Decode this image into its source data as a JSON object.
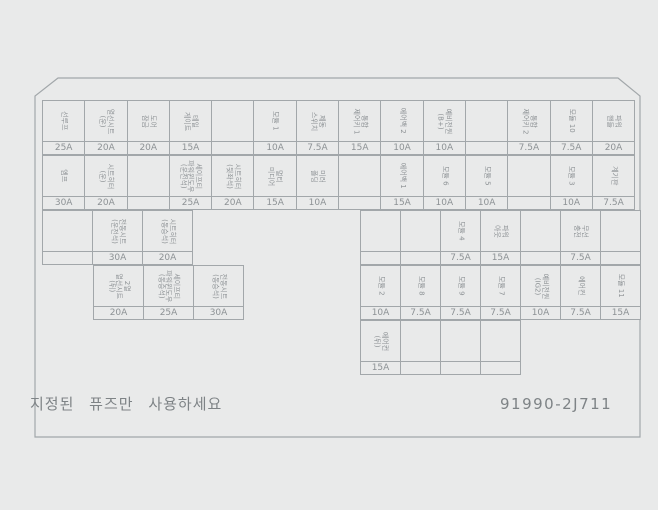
{
  "panel": {
    "warning_text": "지정된 퓨즈만 사용하세요",
    "part_number": "91990-2J711",
    "colors": {
      "line": "#a2a7aa",
      "text": "#8d9295",
      "background": "#e9eaea"
    },
    "rows": [
      {
        "id": "main-row-1",
        "cells": [
          {
            "label": "선루프",
            "amp": "25A"
          },
          {
            "label": "열선시트\n(운)",
            "amp": "20A"
          },
          {
            "label": "도어\n잠금",
            "amp": "20A"
          },
          {
            "label": "테일\n게이트",
            "amp": "15A"
          },
          {
            "label": "",
            "amp": ""
          },
          {
            "label": "모듈 1",
            "amp": "10A"
          },
          {
            "label": "제동\n스위치",
            "amp": "7.5A"
          },
          {
            "label": "통합\n제어키 1",
            "amp": "15A"
          },
          {
            "label": "에어백 2",
            "amp": "10A"
          },
          {
            "label": "예비전원\n(B+)",
            "amp": "10A"
          },
          {
            "label": "",
            "amp": ""
          },
          {
            "label": "통합\n제어키 2",
            "amp": "7.5A"
          },
          {
            "label": "모듈 10",
            "amp": "7.5A"
          },
          {
            "label": "파워\n핸들",
            "amp": "20A"
          }
        ]
      },
      {
        "id": "main-row-2",
        "cells": [
          {
            "label": "엠프",
            "amp": "30A"
          },
          {
            "label": "시트히터\n(운)",
            "amp": "20A"
          },
          {
            "label": "",
            "amp": ""
          },
          {
            "label": "세이프티\n파워윈도우\n(운전석)",
            "amp": "25A"
          },
          {
            "label": "시트히터\n(뒷좌석)",
            "amp": "20A"
          },
          {
            "label": "멀티\n미디어",
            "amp": "15A"
          },
          {
            "label": "미러\n폴딩",
            "amp": "10A"
          },
          {
            "label": "",
            "amp": ""
          },
          {
            "label": "에어백 1",
            "amp": "15A"
          },
          {
            "label": "모듈 6",
            "amp": "10A"
          },
          {
            "label": "모듈 5",
            "amp": "10A"
          },
          {
            "label": "",
            "amp": ""
          },
          {
            "label": "모듈 3",
            "amp": "10A"
          },
          {
            "label": "계기판",
            "amp": "7.5A"
          }
        ]
      },
      {
        "id": "left-row-3",
        "cells": [
          {
            "label": "",
            "amp": ""
          },
          {
            "label": "전동시트\n(운전석)",
            "amp": "30A"
          },
          {
            "label": "시트히터\n(동승석)",
            "amp": "20A"
          }
        ]
      },
      {
        "id": "left-row-4",
        "cells": [
          {
            "label": "2열\n열선시트\n(뒤)",
            "amp": "20A"
          },
          {
            "label": "세이프티\n파워윈도우\n(동승석)",
            "amp": "25A"
          },
          {
            "label": "전동시트\n(동승석)",
            "amp": "30A"
          }
        ]
      },
      {
        "id": "right-row-3",
        "cells": [
          {
            "label": "",
            "amp": ""
          },
          {
            "label": "",
            "amp": ""
          },
          {
            "label": "모듈 4",
            "amp": "7.5A"
          },
          {
            "label": "파워\n아웃",
            "amp": "15A"
          },
          {
            "label": "",
            "amp": ""
          },
          {
            "label": "무선\n충전",
            "amp": "7.5A"
          },
          {
            "label": "",
            "amp": ""
          }
        ]
      },
      {
        "id": "right-row-4",
        "cells": [
          {
            "label": "모듈 2",
            "amp": "10A"
          },
          {
            "label": "모듈 8",
            "amp": "7.5A"
          },
          {
            "label": "모듈 9",
            "amp": "7.5A"
          },
          {
            "label": "모듈 7",
            "amp": "7.5A"
          },
          {
            "label": "예비전원\n(IG2)",
            "amp": "10A"
          },
          {
            "label": "에어컨",
            "amp": "7.5A"
          },
          {
            "label": "모듈 11",
            "amp": "15A"
          }
        ]
      },
      {
        "id": "right-row-5",
        "cells": [
          {
            "label": "에어컨\n(뒤)",
            "amp": "15A"
          },
          {
            "label": "",
            "amp": ""
          },
          {
            "label": "",
            "amp": ""
          },
          {
            "label": "",
            "amp": ""
          }
        ]
      }
    ]
  }
}
